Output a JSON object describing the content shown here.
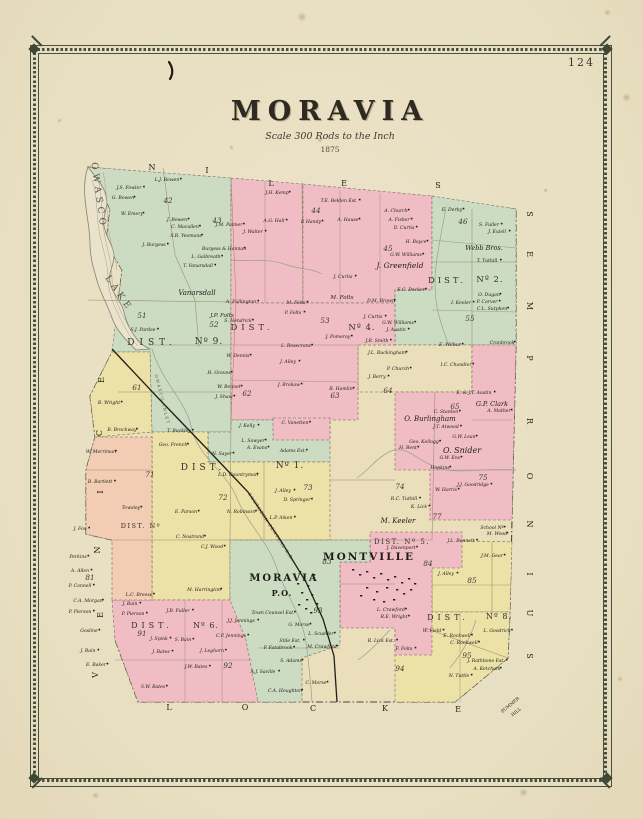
{
  "page": {
    "number": "124"
  },
  "title": {
    "text": "MORAVIA",
    "scale": "Scale 300 Rods to the Inch",
    "year": "1875"
  },
  "map": {
    "palette": {
      "green": "#ccdcc2",
      "pink": "#f1bdc4",
      "yellow": "#ece1a7",
      "cream": "#eadfba",
      "salmon": "#f2ccb3",
      "paper": "#e9e0c4",
      "water": "#e9e3cc",
      "line": "#6f6656",
      "ink": "#22201a"
    },
    "border_towns": {
      "top": "NILES",
      "right": "SEMPRONIUS",
      "bottom": "LOCKE",
      "left": "VENICE",
      "corner": "SUMMER HILL"
    },
    "edge_letters": {
      "niles": [
        [
          "N",
          152,
          170
        ],
        [
          "I",
          207,
          173
        ],
        [
          "L",
          271,
          186
        ],
        [
          "E",
          344,
          186
        ],
        [
          "S",
          438,
          188
        ]
      ],
      "sempronius": [
        [
          "S",
          527,
          214
        ],
        [
          "E",
          527,
          254
        ],
        [
          "M",
          527,
          306
        ],
        [
          "P",
          527,
          358
        ],
        [
          "R",
          527,
          421
        ],
        [
          "O",
          527,
          476
        ],
        [
          "N",
          527,
          524
        ],
        [
          "I",
          527,
          574
        ],
        [
          "U",
          527,
          613
        ],
        [
          "S",
          527,
          656
        ]
      ],
      "locke": [
        [
          "L",
          169,
          710
        ],
        [
          "O",
          245,
          710
        ],
        [
          "C",
          313,
          711
        ],
        [
          "K",
          385,
          711
        ],
        [
          "E",
          458,
          712
        ]
      ],
      "venice": [
        [
          "E",
          104,
          380
        ],
        [
          "C",
          102,
          433
        ],
        [
          "I",
          103,
          492
        ],
        [
          "N",
          100,
          550
        ],
        [
          "E",
          103,
          615
        ],
        [
          "V",
          98,
          675
        ]
      ],
      "corner": [
        [
          "SUMMER",
          511,
          706
        ],
        [
          "HILL",
          517,
          713
        ]
      ]
    },
    "water_labels": [
      {
        "t": "OWASCO",
        "x": 96,
        "y": 196,
        "r": 82,
        "s": 9,
        "ls": 4
      },
      {
        "t": "LAKE",
        "x": 117,
        "y": 295,
        "r": 55,
        "s": 9,
        "ls": 4
      },
      {
        "t": "OWASCO INLET",
        "x": 161,
        "y": 400,
        "r": 76,
        "s": 4,
        "ls": 1.5
      }
    ],
    "railroad_label": {
      "t": "SOUTHERN CENTRAL R.R.",
      "x": 270,
      "y": 528,
      "r": 57,
      "s": 4.2
    },
    "district_labels": [
      {
        "t": "DIST.",
        "x": 152,
        "y": 345,
        "s": 9,
        "ls": 5
      },
      {
        "t": "Nº 9.",
        "x": 209,
        "y": 344,
        "s": 9,
        "ls": 1
      },
      {
        "t": "DIST.",
        "x": 252,
        "y": 330,
        "s": 8.5,
        "ls": 4
      },
      {
        "t": "Nº 4.",
        "x": 362,
        "y": 330,
        "s": 8.5,
        "ls": 1
      },
      {
        "t": "DIST.",
        "x": 447,
        "y": 283,
        "s": 8.5,
        "ls": 3
      },
      {
        "t": "Nº 2.",
        "x": 490,
        "y": 282,
        "s": 8.5,
        "ls": 1
      },
      {
        "t": "DIST.",
        "x": 203,
        "y": 470,
        "s": 9,
        "ls": 4
      },
      {
        "t": "Nº 1.",
        "x": 290,
        "y": 468,
        "s": 9,
        "ls": 1
      },
      {
        "t": "DIST. Nº 5.",
        "x": 402,
        "y": 544,
        "s": 7,
        "ls": 1.5
      },
      {
        "t": "DIST.",
        "x": 448,
        "y": 620,
        "s": 8,
        "ls": 4
      },
      {
        "t": "Nº 8.",
        "x": 499,
        "y": 619,
        "s": 8,
        "ls": 1
      },
      {
        "t": "DIST.",
        "x": 152,
        "y": 628,
        "s": 8,
        "ls": 4
      },
      {
        "t": "Nº 6.",
        "x": 206,
        "y": 628,
        "s": 8,
        "ls": 1
      },
      {
        "t": "DIST. Nº",
        "x": 141,
        "y": 528,
        "s": 6.5,
        "ls": 1.5
      }
    ],
    "place_labels": [
      {
        "t": "MORAVIA",
        "x": 284,
        "y": 581,
        "s": 10,
        "ls": 2
      },
      {
        "t": "P.O.",
        "x": 282,
        "y": 596,
        "s": 8,
        "ls": 1
      },
      {
        "t": "MONTVILLE",
        "x": 369,
        "y": 560,
        "s": 10.5,
        "ls": 2
      }
    ],
    "big_names": [
      [
        "Vanarsdall",
        197,
        295,
        7
      ],
      [
        "J. Greenfield",
        400,
        268,
        7.5
      ],
      [
        "Webb Bros.",
        484,
        250,
        6.5
      ],
      [
        "O. Burlingham",
        430,
        421,
        7
      ],
      [
        "O. Snider",
        462,
        453,
        8
      ],
      [
        "G.P. Clark",
        492,
        406,
        6.5
      ],
      [
        "M. Keeler",
        398,
        523,
        7
      ],
      [
        "J.P. Folts",
        222,
        317,
        5.6
      ],
      [
        "M. Folts",
        342,
        299,
        5.6
      ]
    ],
    "lot_numbers": [
      [
        "42",
        168,
        203
      ],
      [
        "43",
        217,
        223
      ],
      [
        "44",
        316,
        213
      ],
      [
        "45",
        388,
        251
      ],
      [
        "46",
        463,
        224
      ],
      [
        "51",
        142,
        318
      ],
      [
        "52",
        214,
        327
      ],
      [
        "53",
        325,
        323
      ],
      [
        "55",
        470,
        321
      ],
      [
        "61",
        137,
        390
      ],
      [
        "62",
        247,
        396
      ],
      [
        "63",
        335,
        398
      ],
      [
        "64",
        388,
        393
      ],
      [
        "65",
        455,
        409
      ],
      [
        "71",
        150,
        477
      ],
      [
        "72",
        223,
        500
      ],
      [
        "73",
        308,
        490
      ],
      [
        "74",
        400,
        489
      ],
      [
        "75",
        483,
        480
      ],
      [
        "77",
        437,
        519
      ],
      [
        "81",
        90,
        580
      ],
      [
        "83",
        327,
        564
      ],
      [
        "84",
        428,
        566
      ],
      [
        "85",
        472,
        583
      ],
      [
        "91",
        142,
        636
      ],
      [
        "92",
        228,
        668
      ],
      [
        "93",
        318,
        613
      ],
      [
        "94",
        400,
        671
      ],
      [
        "95",
        467,
        658
      ]
    ],
    "names": [
      [
        "L.J. Bowen",
        167,
        181
      ],
      [
        "J.S. Fowler",
        129,
        189
      ],
      [
        "G. Bowen",
        123,
        199
      ],
      [
        "W. Emery",
        132,
        215
      ],
      [
        "J. Bowen",
        177,
        221
      ],
      [
        "S.R. Yeomans",
        186,
        237
      ],
      [
        "C. Macallen",
        185,
        228
      ],
      [
        "J. Burgess",
        154,
        246
      ],
      [
        "Burgess & Hannan",
        224,
        250
      ],
      [
        "L. Galbreath",
        206,
        258
      ],
      [
        "T. Vanarsdall",
        198,
        267
      ],
      [
        "S.J. Pardee",
        143,
        331
      ],
      [
        "S. Hendrick",
        238,
        322
      ],
      [
        "A. Fullington",
        241,
        303
      ],
      [
        "W. Dennis",
        238,
        357
      ],
      [
        "H. Graves",
        219,
        374
      ],
      [
        "W. Bennet",
        229,
        388
      ],
      [
        "J. Shaw",
        224,
        398
      ],
      [
        "B. Wright",
        109,
        404
      ],
      [
        "W. Merriman",
        101,
        453
      ],
      [
        "B. Brockway",
        122,
        431
      ],
      [
        "T. Buckley",
        179,
        432
      ],
      [
        "Geo. French",
        173,
        446
      ],
      [
        "J.H. Kemp",
        277,
        194
      ],
      [
        "T.E. Belden Est.",
        339,
        202
      ],
      [
        "A. Church",
        396,
        212
      ],
      [
        "A. Fisher",
        399,
        221
      ],
      [
        "D. Curtis",
        404,
        229
      ],
      [
        "A. Hause",
        348,
        221
      ],
      [
        "P. Handy",
        311,
        223
      ],
      [
        "A.G. Hall",
        274,
        222
      ],
      [
        "J.M. Palmer",
        229,
        226
      ],
      [
        "J. Walter",
        253,
        233
      ],
      [
        "E. Derby",
        452,
        211
      ],
      [
        "S. Fuller",
        489,
        226
      ],
      [
        "J. Extell",
        497,
        233
      ],
      [
        "H. Boyce",
        416,
        243
      ],
      [
        "G.W. Williams",
        406,
        256
      ],
      [
        "T. Tuthill",
        487,
        262
      ],
      [
        "I. Keeler",
        461,
        304
      ],
      [
        "O. Dugan",
        489,
        296
      ],
      [
        "P. Carver",
        487,
        303
      ],
      [
        "C.L. Sutphen",
        492,
        310
      ],
      [
        "Cranbrook",
        502,
        344
      ],
      [
        "E.C. Decker",
        411,
        291
      ],
      [
        "D.M. Brown",
        381,
        302
      ],
      [
        "J. Curtis",
        343,
        278
      ],
      [
        "J. Curtis",
        373,
        318
      ],
      [
        "G.W. Williams",
        398,
        324
      ],
      [
        "J. Austin",
        396,
        331
      ],
      [
        "E. Wilbur",
        450,
        346
      ],
      [
        "I.C. Chandler",
        456,
        366
      ],
      [
        "M. Folts",
        296,
        304
      ],
      [
        "P. Folts",
        293,
        314
      ],
      [
        "J. Pomeroy",
        338,
        338
      ],
      [
        "J.B. Smith",
        377,
        342
      ],
      [
        "J.L. Buckingham",
        387,
        354
      ],
      [
        "L. Rosecrans",
        296,
        347
      ],
      [
        "J. Alley",
        288,
        363
      ],
      [
        "J. Brokaw",
        289,
        386
      ],
      [
        "R. Hamlin",
        341,
        390
      ],
      [
        "P. Church",
        398,
        370
      ],
      [
        "J. Berry",
        377,
        378
      ],
      [
        "E. & J.T. Austin",
        474,
        394
      ],
      [
        "C. Stanton",
        446,
        413
      ],
      [
        "A. Mather",
        499,
        412
      ],
      [
        "J.T. Atwood",
        446,
        428
      ],
      [
        "G.W. Lean",
        464,
        438
      ],
      [
        "Geo. Kellogg",
        424,
        443
      ],
      [
        "H. Bent",
        408,
        449
      ],
      [
        "G.W. Eno",
        450,
        459
      ],
      [
        "Hopkins",
        440,
        469
      ],
      [
        "J.J. Goodridge",
        473,
        486
      ],
      [
        "W. Harris",
        446,
        491
      ],
      [
        "K. Lick",
        419,
        508
      ],
      [
        "R.C. Tuthill",
        404,
        500
      ],
      [
        "J. Kelly",
        247,
        427
      ],
      [
        "L. Sawyer",
        253,
        442
      ],
      [
        "A. Evans",
        257,
        449
      ],
      [
        "Adams Est.",
        293,
        452
      ],
      [
        "N. Sayer",
        222,
        455
      ],
      [
        "L.D. Countryman",
        238,
        476
      ],
      [
        "J. Alley",
        283,
        492
      ],
      [
        "D. Springer",
        297,
        501
      ],
      [
        "N. Robinson",
        241,
        513
      ],
      [
        "L.P. Aiken",
        281,
        519
      ],
      [
        "E. Parson",
        186,
        513
      ],
      [
        "C. Nostrand",
        190,
        538
      ],
      [
        "C.J. Wood",
        212,
        548
      ],
      [
        "M. Harrington",
        204,
        591
      ],
      [
        "C. Vanetten",
        295,
        424
      ],
      [
        "B. Bartlett",
        100,
        483
      ],
      [
        "Towsley",
        131,
        509
      ],
      [
        "J. Fox",
        80,
        530
      ],
      [
        "Perkins",
        78,
        558
      ],
      [
        "A. Allen",
        80,
        572
      ],
      [
        "P. Connell",
        80,
        587
      ],
      [
        "C.A. Morgan",
        88,
        602
      ],
      [
        "P. Pierson",
        80,
        613
      ],
      [
        "Gosline",
        89,
        632
      ],
      [
        "J. Bain",
        88,
        652
      ],
      [
        "E. Baker",
        96,
        666
      ],
      [
        "L.C. Breese",
        139,
        596
      ],
      [
        "J. Bain",
        130,
        605
      ],
      [
        "P. Pierson",
        133,
        615
      ],
      [
        "J.B. Fuller",
        178,
        612
      ],
      [
        "J.J. Jennings",
        241,
        622
      ],
      [
        "C.P. Jennings",
        231,
        637
      ],
      [
        "J. Spink",
        159,
        640
      ],
      [
        "S. Bain",
        183,
        641
      ],
      [
        "J. Bates",
        161,
        653
      ],
      [
        "J. Leghorn",
        212,
        652
      ],
      [
        "J.W. Bates",
        196,
        668
      ],
      [
        "S.W. Bates",
        153,
        688
      ],
      [
        "Town Counsel Est.",
        273,
        614
      ],
      [
        "G. Morse",
        299,
        626
      ],
      [
        "L. Scudder",
        321,
        635
      ],
      [
        "Stile Est.",
        290,
        642
      ],
      [
        "P. Estabrook",
        278,
        649
      ],
      [
        "M. Crawford",
        322,
        648
      ],
      [
        "S. Adams",
        291,
        662
      ],
      [
        "A.J. Saville",
        263,
        673
      ],
      [
        "C.A. Houghton",
        285,
        692
      ],
      [
        "C. Morse",
        316,
        684
      ],
      [
        "J. Davenport",
        401,
        549
      ],
      [
        "J.L. Bennett",
        461,
        542
      ],
      [
        "School Nº",
        492,
        529
      ],
      [
        "M. Wood",
        497,
        535
      ],
      [
        "J.M. Gear",
        492,
        557
      ],
      [
        "J. Alley",
        446,
        575
      ],
      [
        "L. Crawford",
        391,
        611
      ],
      [
        "R.E. Wright",
        394,
        618
      ],
      [
        "R. Lick Est.",
        381,
        642
      ],
      [
        "F. Folts",
        404,
        650
      ],
      [
        "L. Goodrich",
        497,
        632
      ],
      [
        "W. Field",
        432,
        632
      ],
      [
        "E. Rockwell",
        457,
        637
      ],
      [
        "C. Rockwell",
        464,
        644
      ],
      [
        "J. Rathbone Est.",
        486,
        662
      ],
      [
        "A. Ketchum",
        487,
        670
      ],
      [
        "N. Tuttle",
        459,
        677
      ]
    ]
  }
}
